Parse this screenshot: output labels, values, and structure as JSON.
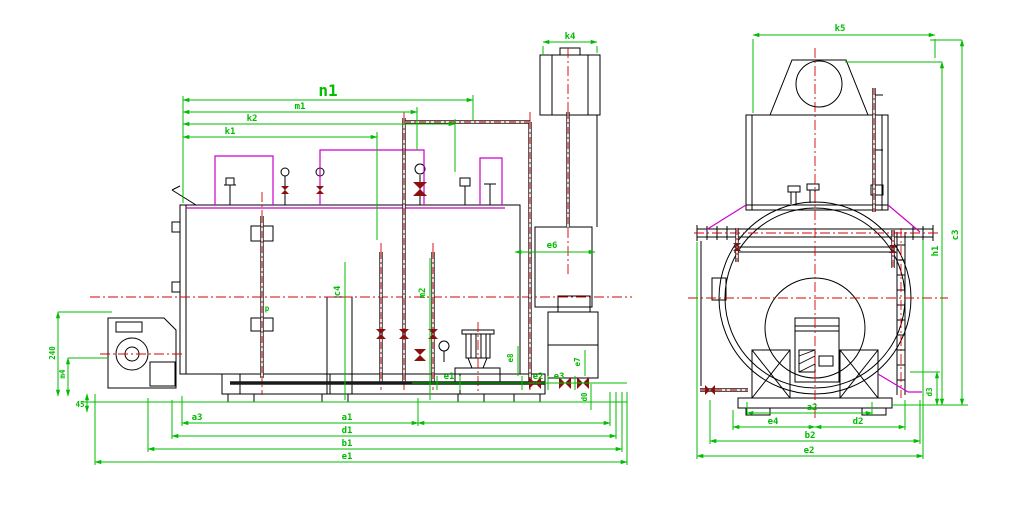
{
  "drawing": {
    "colors": {
      "dimension": "#00bd00",
      "centerline": "#d40000",
      "pipe_accent": "#8b0f0f",
      "piping_magenta": "#cc00cc",
      "outline": "#000000",
      "background": "#ffffff"
    },
    "side_view": {
      "dims": {
        "n1": "n1",
        "m1": "m1",
        "k2": "k2",
        "k1": "k1",
        "k4": "k4",
        "e6": "e6",
        "c4": "c4",
        "m2": "m2",
        "e1_pipe": "e1",
        "e2_pipe": "e2",
        "e3_pipe": "e3",
        "e7": "e7",
        "e8": "e8",
        "d0": "d0",
        "height_240": "240",
        "offset_m4": "m4",
        "base_45": "45",
        "p": "p",
        "a3": "a3",
        "a1": "a1",
        "d1": "d1",
        "b1": "b1",
        "e1": "e1"
      }
    },
    "front_view": {
      "dims": {
        "k5": "k5",
        "h1": "h1",
        "c3": "c3",
        "d3": "d3",
        "a2": "a2",
        "e4": "e4",
        "d2": "d2",
        "b2": "b2",
        "e2": "e2"
      }
    }
  }
}
